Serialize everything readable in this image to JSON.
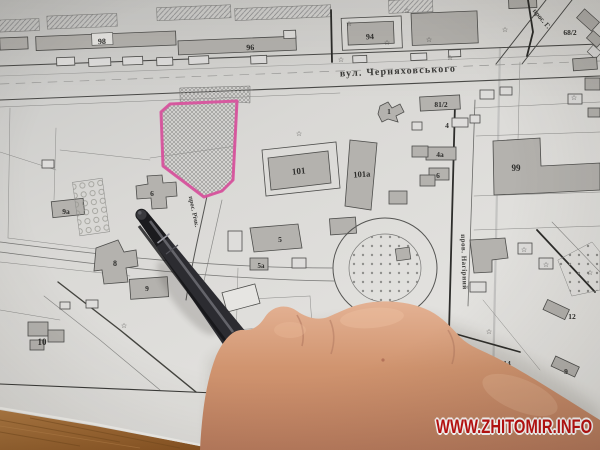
{
  "watermark": {
    "text": "WWW.ZHITOMIR.INFO",
    "color": "#c01010"
  },
  "map": {
    "streets": {
      "chernyakhovskoho": "вул. Черняховського",
      "nahirnyi": "пров. Нагірний",
      "richkovyi": "прос. Річк.",
      "prospekt": "прос. Г."
    },
    "labels": {
      "b98": "98",
      "b96": "96",
      "b94": "94",
      "b68_2": "68/2",
      "b81_2": "81/2",
      "b1": "1",
      "b4": "4",
      "b4a": "4а",
      "b6r": "6",
      "b99": "99",
      "b101": "101",
      "b101a": "101а",
      "b9a": "9а",
      "b6l": "6",
      "b5": "5",
      "b5a": "5а",
      "b8": "8",
      "b9": "9",
      "b10": "10",
      "b12": "12",
      "b14": "14",
      "b9b": "9"
    },
    "icons": {
      "star": "☆"
    },
    "highlight_color": "#d8509c"
  }
}
